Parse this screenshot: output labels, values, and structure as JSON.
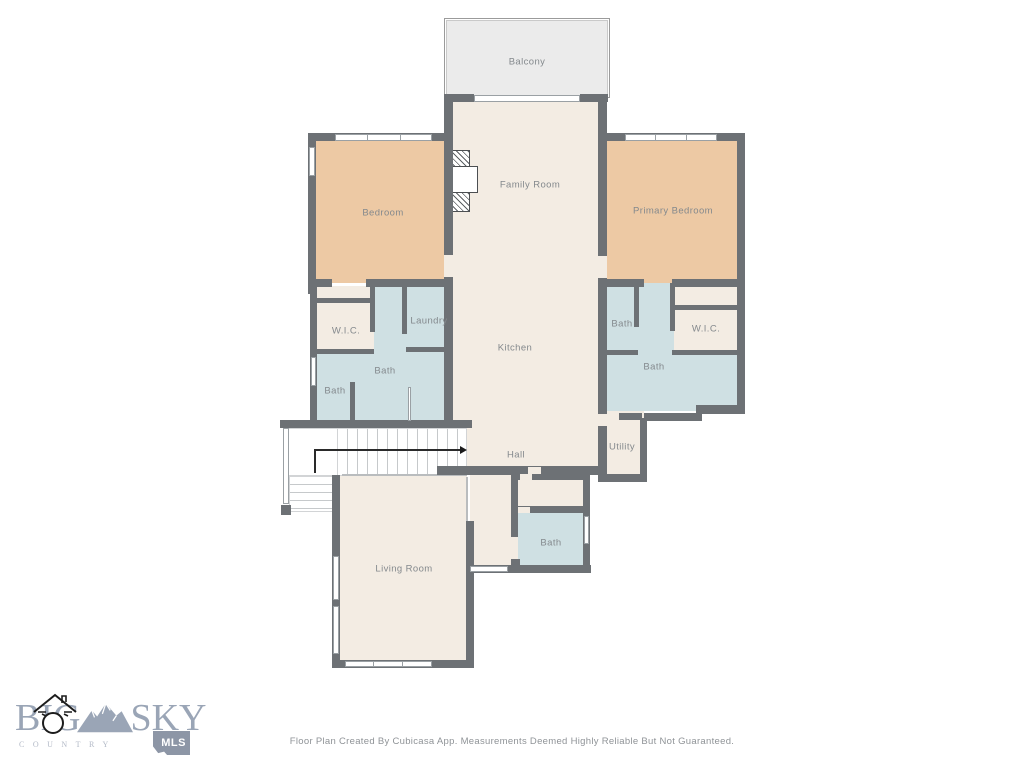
{
  "floorplan": {
    "rooms": {
      "balcony": "Balcony",
      "family_room": "Family Room",
      "bedroom": "Bedroom",
      "primary_bedroom": "Primary Bedroom",
      "wic_left": "W.I.C.",
      "laundry": "Laundry",
      "bath_left_large": "Bath",
      "bath_left_small": "Bath",
      "kitchen": "Kitchen",
      "bath_right_small": "Bath",
      "wic_right": "W.I.C.",
      "bath_right_large": "Bath",
      "utility": "Utility",
      "hall": "Hall",
      "bath_lower": "Bath",
      "living_room": "Living Room"
    },
    "caption": "Floor Plan Created By Cubicasa App. Measurements Deemed Highly Reliable But Not Guaranteed.",
    "colors": {
      "wall": "#6d7175",
      "room_fill": "#f3ece3",
      "bedroom_fill": "#edc9a4",
      "bath_fill": "#cfe0e3",
      "balcony_fill": "#ebebeb",
      "label_text": "#84898d",
      "logo_blue": "#9aa5b6"
    }
  },
  "logo": {
    "word1": "BIG",
    "word2": "SKY",
    "word3": "COUNTRY",
    "badge": "MLS"
  }
}
